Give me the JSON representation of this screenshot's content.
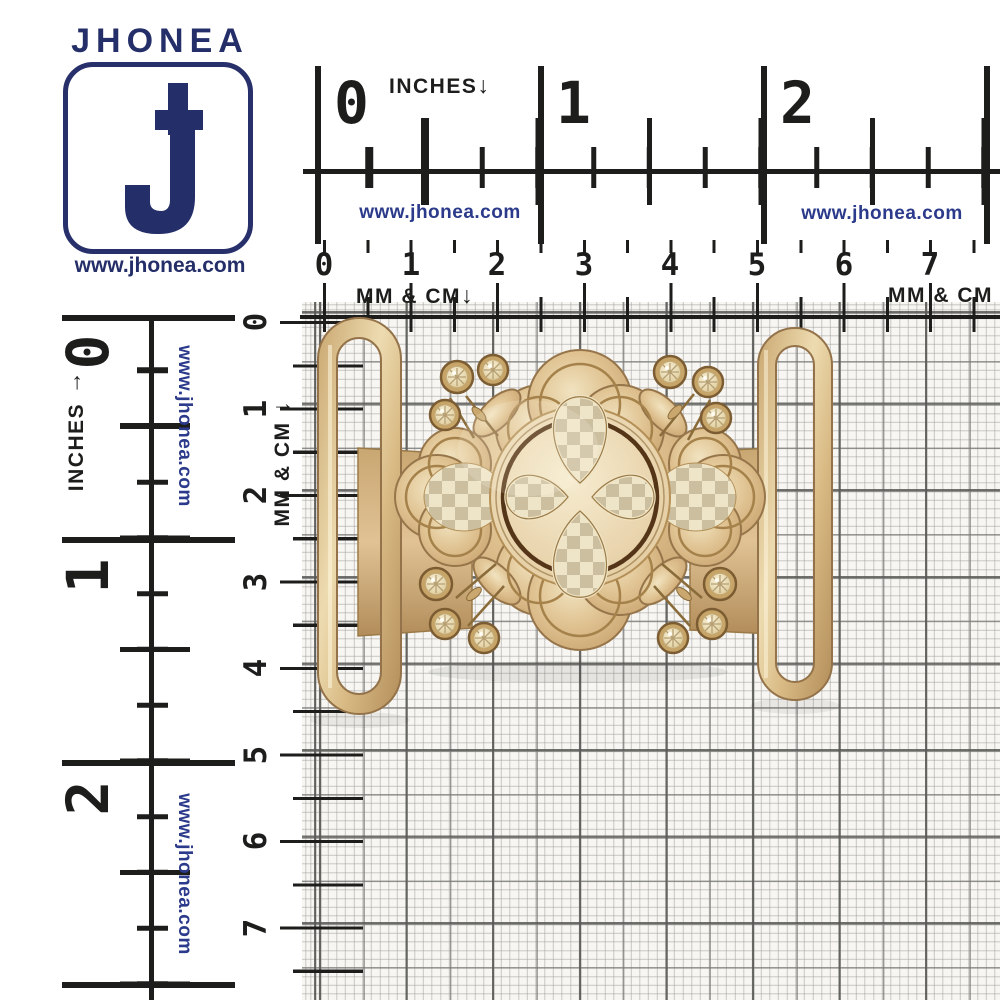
{
  "brand": {
    "name": "JHONEA",
    "website": "www.jhonea.com"
  },
  "colors": {
    "navy": "#242e68",
    "link_blue": "#2b3a8a",
    "ruler_ink": "#1d1d1b",
    "paper": "#f7f6f2",
    "gold_light": "#f1e3c0",
    "gold_mid": "#dcbd8b",
    "gold_deep": "#b18c58",
    "engrave_brown": "#7c5a2e"
  },
  "rulers": {
    "top_inches": {
      "label": "INCHES",
      "arrow": "↓",
      "marks": [
        "0",
        "1",
        "2"
      ],
      "watermarks": [
        "www.jhonea.com",
        "www.jhonea.com"
      ]
    },
    "top_cm": {
      "label_left": "MM & CM",
      "arrow_left": "↓",
      "label_right": "MM & CM",
      "marks": [
        "0",
        "1",
        "2",
        "3",
        "4",
        "5",
        "6",
        "7"
      ]
    },
    "left_inches": {
      "label": "INCHES",
      "arrow": "↑",
      "marks": [
        "0",
        "1",
        "2"
      ],
      "watermarks": [
        "www.jhonea.com",
        "www.jhonea.com"
      ]
    },
    "left_cm": {
      "label": "MM & CM",
      "arrow": "→",
      "marks": [
        "0",
        "1",
        "2",
        "3",
        "4",
        "5",
        "6",
        "7"
      ]
    }
  }
}
